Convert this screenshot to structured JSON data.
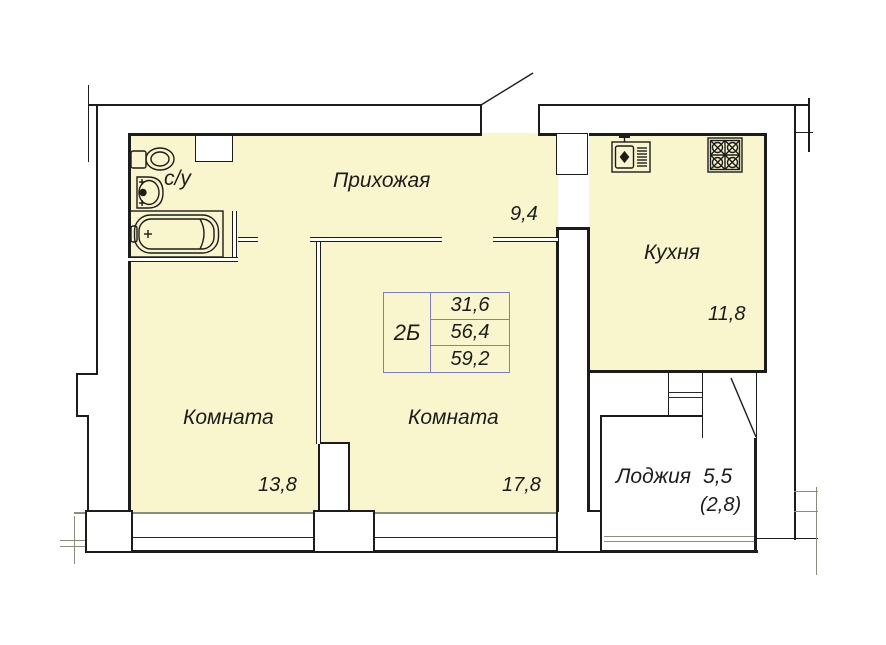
{
  "rooms": {
    "hallway": {
      "label": "Прихожая",
      "area": "9,4"
    },
    "kitchen": {
      "label": "Кухня",
      "area": "11,8"
    },
    "room_left": {
      "label": "Комната",
      "area": "13,8"
    },
    "room_right": {
      "label": "Комната",
      "area": "17,8"
    },
    "loggia": {
      "label": "Лоджия",
      "area": "5,5",
      "area_note": "(2,8)"
    },
    "bathroom": {
      "label": "с/у"
    }
  },
  "info_table": {
    "type": "2Б",
    "rows": [
      "31,6",
      "56,4",
      "59,2"
    ]
  },
  "colors": {
    "floor": "#f9f6cd",
    "wall_line": "#1c1c1c",
    "window_line": "#8d8d7c",
    "table_border": "#7d7dc9"
  }
}
